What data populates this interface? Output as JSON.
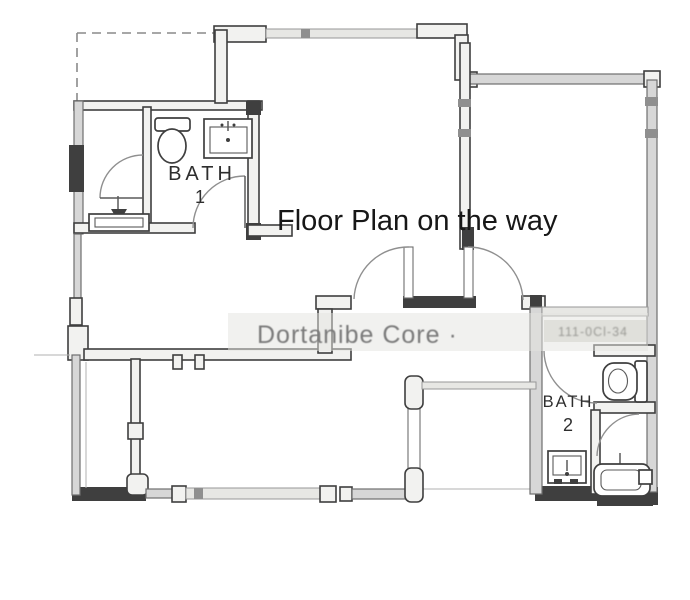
{
  "overlay": {
    "title": "Floor Plan on the way"
  },
  "watermark": {
    "text": "Dortanibe Core ·",
    "stamp": "111-0Cl-34"
  },
  "rooms": {
    "bath1": {
      "name": "BATH 1",
      "label_top": "BATH",
      "label_bottom": "1"
    },
    "bath2": {
      "name": "BATH 2",
      "label_top": "BATH",
      "label_bottom": "2"
    }
  },
  "fixtures": [
    "toilet",
    "sink",
    "pedestal-sink",
    "vanity",
    "bathtub",
    "door-swing",
    "window"
  ],
  "colors": {
    "ink": "#3f3f3f",
    "wall_fill": "#f2f2f0",
    "wall_gray": "#d7d7d7",
    "window_line": "#979797",
    "arc": "#8f8f8f",
    "title_ink": "#171717",
    "watermark_ink": "#7a7a7a",
    "stamp_ink": "#999994",
    "band": "#e4e4e0",
    "label_ink": "#2e2e2e",
    "paper": "#ffffff"
  }
}
